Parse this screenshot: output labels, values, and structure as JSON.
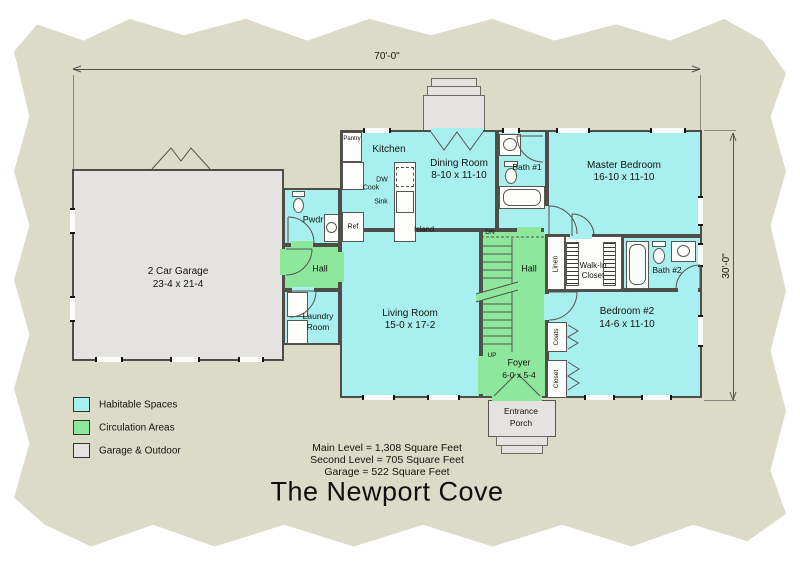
{
  "title": "The Newport Cove",
  "dims": {
    "width_label": "70'-0\"",
    "depth_label": "30'-0\""
  },
  "rooms": {
    "garage": {
      "name": "2 Car Garage",
      "size": "23-4 x 21-4"
    },
    "pwdr": {
      "name": "Pwdr"
    },
    "hall_west": {
      "name": "Hall"
    },
    "laundry": {
      "line1": "Laundry",
      "line2": "Room"
    },
    "kitchen": {
      "name": "Kitchen"
    },
    "dining": {
      "name": "Dining Room",
      "size": "8-10 x 11-10"
    },
    "bath1": {
      "name": "Bath #1"
    },
    "master": {
      "name": "Master Bedroom",
      "size": "16-10 x 11-10"
    },
    "living": {
      "name": "Living Room",
      "size": "15-0 x 17-2"
    },
    "hall_center": {
      "name": "Hall"
    },
    "linen": {
      "name": "Linen"
    },
    "wic": {
      "line1": "Walk-In",
      "line2": "Closet"
    },
    "bath2": {
      "name": "Bath #2"
    },
    "bedroom2": {
      "name": "Bedroom #2",
      "size": "14-6 x 11-10"
    },
    "foyer": {
      "name": "Foyer",
      "size": "6-0 x 5-4"
    },
    "coats": {
      "name": "Coats"
    },
    "closet": {
      "name": "Closet"
    },
    "porch": {
      "line1": "Entrance",
      "line2": "Porch"
    }
  },
  "fixtures": {
    "pantry": "Pantry",
    "dw": "DW",
    "cook": "Cook",
    "sink": "Sink",
    "ref": "Ref",
    "island": "Island",
    "up": "UP",
    "dn": "DN"
  },
  "legend": {
    "habitable": {
      "label": "Habitable Spaces",
      "color": "#a8eff0"
    },
    "circulation": {
      "label": "Circulation Areas",
      "color": "#8de89b"
    },
    "garage_outdoor": {
      "label": "Garage & Outdoor",
      "color": "#e4e3df"
    }
  },
  "areas": {
    "main": "Main Level = 1,308 Square Feet",
    "second": "Second Level = 705 Square Feet",
    "garage": "Garage = 522 Square Feet"
  }
}
